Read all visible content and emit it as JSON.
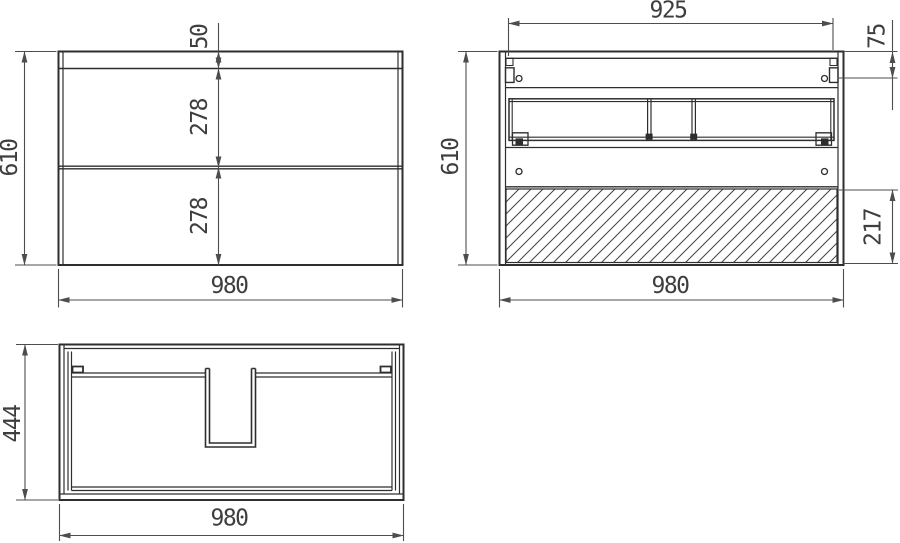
{
  "drawing": {
    "title": "cabinet-three-view-technical-drawing",
    "background": "#ffffff",
    "line_color": "#2e2e2e",
    "dim_color": "#4d4d4d",
    "views": {
      "front": {
        "label": "front-elevation-two-drawers",
        "dims": {
          "height": "610",
          "top_rail_height": "50",
          "upper_drawer_height": "278",
          "lower_drawer_height": "278",
          "width": "980"
        }
      },
      "back": {
        "label": "rear-elevation-hatched-bottom-panel",
        "dims": {
          "hanger_span": "925",
          "hanger_offset": "75",
          "height": "610",
          "bottom_panel_height": "217",
          "width": "980"
        }
      },
      "top": {
        "label": "plan-view-with-siphon-cutout",
        "dims": {
          "depth": "444",
          "width": "980"
        }
      }
    }
  }
}
